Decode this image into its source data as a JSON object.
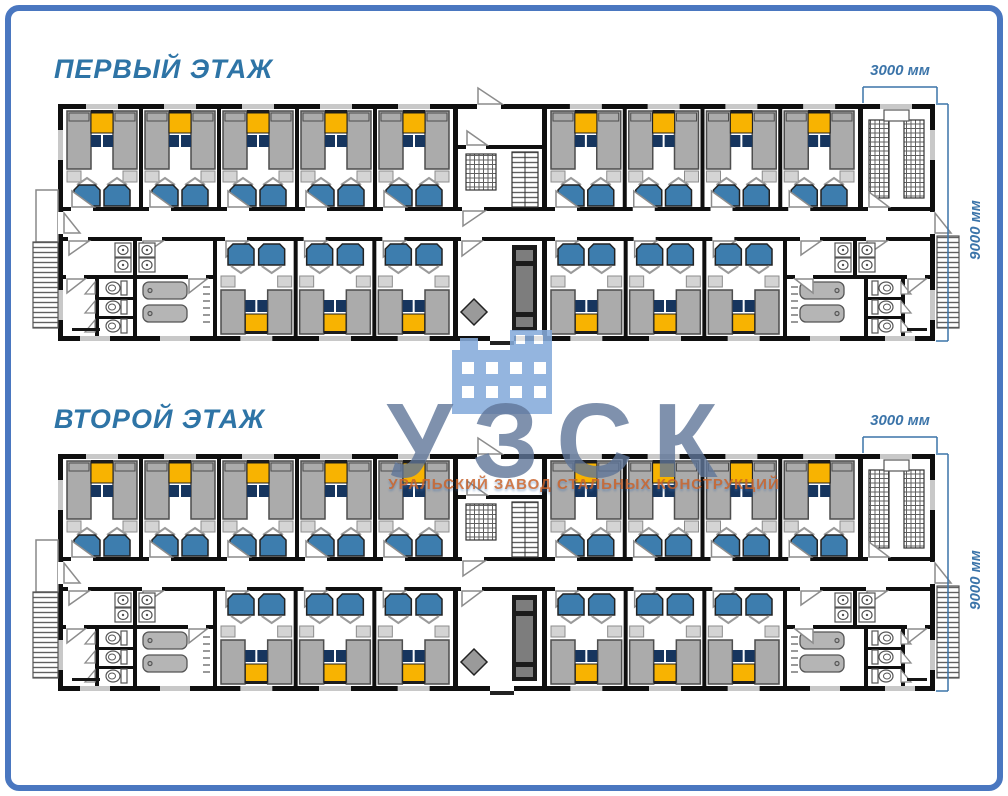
{
  "page": {
    "width": 1008,
    "height": 796,
    "background": "#ffffff",
    "border_color": "#4a77c0"
  },
  "floors": [
    {
      "title": "ПЕРВЫЙ ЭТАЖ",
      "dim_width": "3000 мм",
      "dim_depth": "9000 мм"
    },
    {
      "title": "ВТОРОЙ ЭТАЖ",
      "dim_width": "3000 мм",
      "dim_depth": "9000 мм"
    }
  ],
  "watermark": {
    "acronym": "УЗСК",
    "subtitle": "УРАЛЬСКИЙ ЗАВОД СТАЛЬНЫХ КОНСТРУКЦИЙ",
    "icon": "factory-building-icon",
    "icon_color": "#86abdb",
    "acronym_color": "rgba(95,118,152,0.8)",
    "subtitle_color_top": "#c8632c",
    "subtitle_color_bottom": "#3a6fae"
  },
  "plan": {
    "rooms": {
      "top_left": 5,
      "top_right": 4,
      "bottom_left": 3,
      "bottom_right": 3
    },
    "fixtures": {
      "toilets_per_block": 3,
      "bathtubs_per_block": 2,
      "sink_pairs_per_block": 2,
      "stair_flights": 2
    },
    "palette": {
      "wall": "#0f0f0f",
      "window": "#c8c8c8",
      "bed": "#ababab",
      "bed_stroke": "#4d4d4d",
      "nightstand": "#d4d4d4",
      "table": "#f8b301",
      "table_dark": "#1c1c1c",
      "stool": "#16355e",
      "chair": "#3d7dae",
      "chair_stroke": "#222222",
      "chevron": "#9a9a9a",
      "door": "#8c8c8c",
      "fixture_stroke": "#555555",
      "tub": "#b5b5b5",
      "hatch": "#606060",
      "cabinet": "#1b1b1b",
      "cabinet_inner": "#7d7d7d",
      "diamond": "#9a9a9a",
      "dim": "#3b74a9",
      "title": "#2e74a6"
    }
  }
}
